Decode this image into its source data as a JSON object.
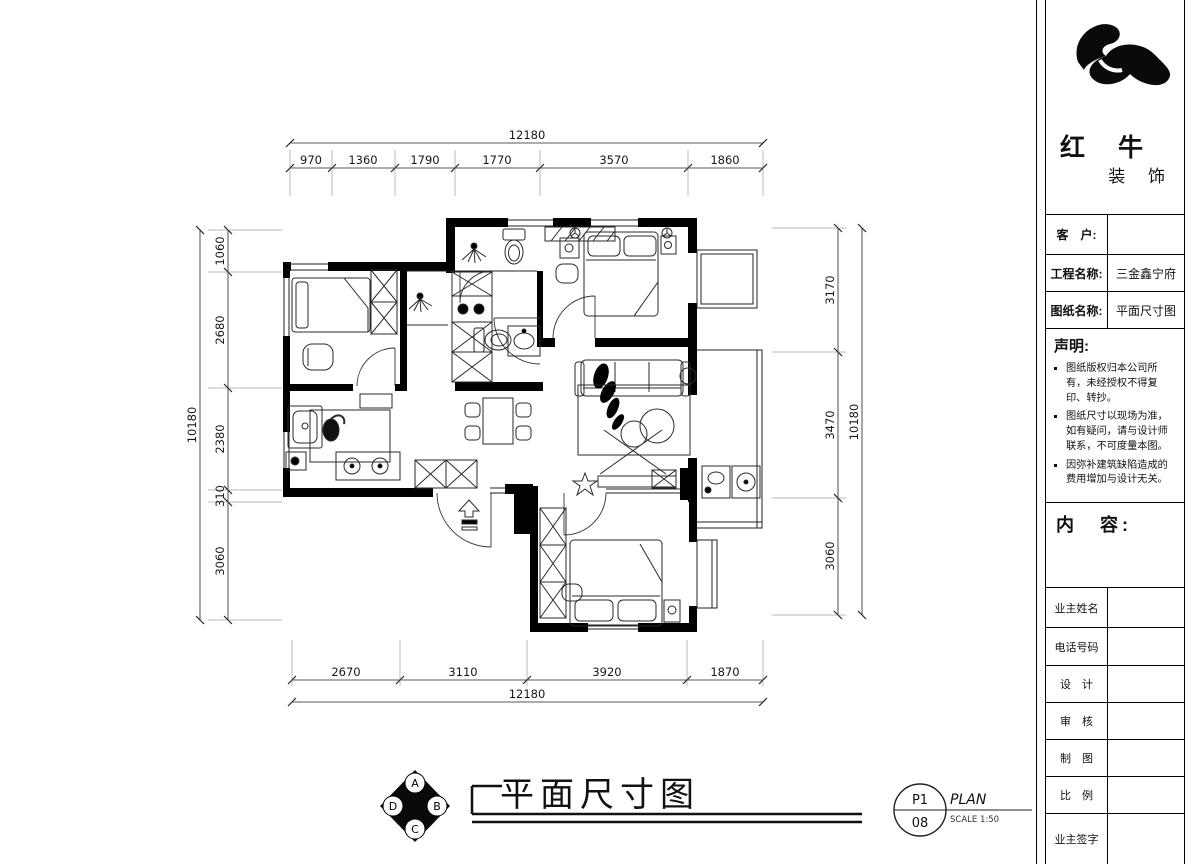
{
  "brand": {
    "name": "红 牛",
    "suffix": "装 饰"
  },
  "title_block": {
    "client_label": "客　户:",
    "client_value": "",
    "project_label": "工程名称:",
    "project_value": "三金鑫宁府",
    "drawing_label": "图纸名称:",
    "drawing_value": "平面尺寸图",
    "statement_title": "声明:",
    "statements": [
      "图纸版权归本公司所有，未经授权不得复印、转抄。",
      "图纸尺寸以现场为准，如有疑问，请与设计师联系，不可度量本图。",
      "因弥补建筑缺陷造成的费用增加与设计无关。"
    ],
    "content_label": "内　容:",
    "sign_rows": [
      {
        "label": "业主姓名",
        "value": ""
      },
      {
        "label": "电话号码",
        "value": ""
      },
      {
        "label": "设　计",
        "value": ""
      },
      {
        "label": "审　核",
        "value": ""
      },
      {
        "label": "制　图",
        "value": ""
      },
      {
        "label": "比　例",
        "value": ""
      },
      {
        "label": "业主签字",
        "value": ""
      }
    ]
  },
  "dimensions": {
    "top": {
      "total": "12180",
      "segments": [
        "970",
        "1360",
        "1790",
        "1770",
        "3570",
        "1860"
      ]
    },
    "bottom": {
      "total": "12180",
      "segments": [
        "2670",
        "3110",
        "3920",
        "1870"
      ]
    },
    "left": {
      "total": "10180",
      "segments": [
        "1060",
        "2680",
        "2380",
        "310",
        "3060"
      ]
    },
    "right": {
      "total": "10180",
      "segments": [
        "3170",
        "3470",
        "3060"
      ]
    }
  },
  "footer": {
    "title": "平面尺寸图",
    "sheet_top": "P1",
    "sheet_bottom": "08",
    "sheet_type": "PLAN",
    "sheet_scale": "SCALE 1:50",
    "compass": {
      "top": "A",
      "right": "B",
      "bottom": "C",
      "left": "D"
    }
  }
}
